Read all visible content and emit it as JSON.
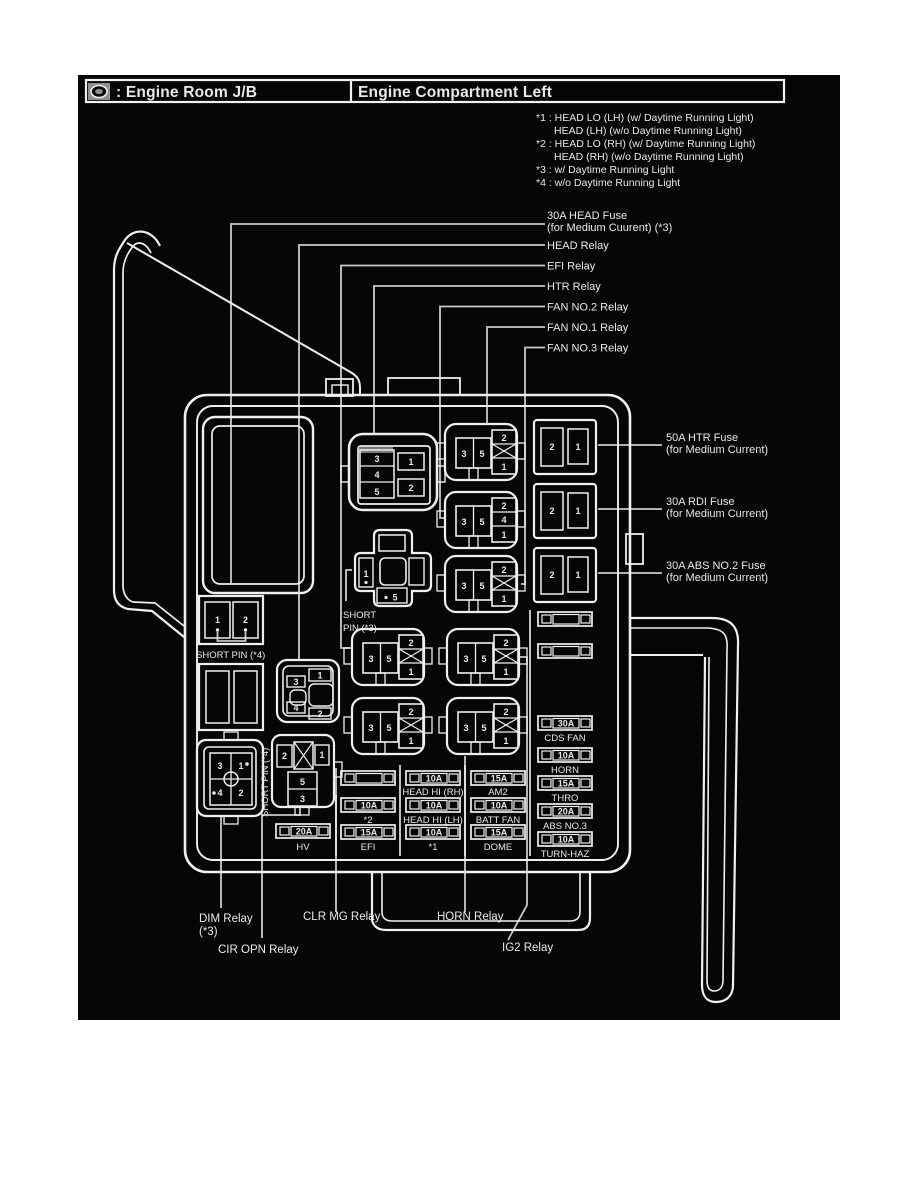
{
  "header": {
    "left_label": ": Engine Room J/B",
    "right_label": "Engine Compartment Left"
  },
  "notes": [
    "*1 : HEAD LO (LH) (w/ Daytime Running Light)",
    "HEAD (LH) (w/o Daytime Running Light)",
    "*2 : HEAD LO (RH) (w/ Daytime Running Light)",
    "HEAD (RH) (w/o Daytime Running Light)",
    "*3 : w/ Daytime Running Light",
    "*4 : w/o Daytime Running Light"
  ],
  "callouts": {
    "head_fuse_1": "30A HEAD Fuse",
    "head_fuse_2": "(for Medium Cuurent) (*3)",
    "head_relay": "HEAD Relay",
    "efi_relay": "EFI Relay",
    "htr_relay": "HTR Relay",
    "fan2_relay": "FAN NO.2 Relay",
    "fan1_relay": "FAN NO.1 Relay",
    "fan3_relay": "FAN NO.3 Relay",
    "htr_fuse_1": "50A HTR Fuse",
    "htr_fuse_2": "(for Medium Current)",
    "rdi_fuse_1": "30A RDI Fuse",
    "rdi_fuse_2": "(for Medium Current)",
    "abs_fuse_1": "30A ABS NO.2 Fuse",
    "abs_fuse_2": "(for Medium Current)",
    "dim_relay_1": "DIM Relay",
    "dim_relay_2": "(*3)",
    "cir_opn_relay": "CIR OPN Relay",
    "clr_mg_relay": "CLR MG Relay",
    "horn_relay": "HORN Relay",
    "ig2_relay": "IG2 Relay",
    "short_pin3_1": "SHORT",
    "short_pin3_2": "PIN (*3)",
    "short_pin4_h": "SHORT PIN (*4)",
    "short_pin4_v": "SHORT PIN (*4)"
  },
  "fuse_grid": {
    "hv": {
      "amp": "20A",
      "name": "HV"
    },
    "star2": {
      "amp": "10A",
      "name": "*2"
    },
    "efi": {
      "amp": "15A",
      "name": "EFI"
    },
    "head_hi_rh": {
      "amp": "10A",
      "name": "HEAD HI (RH)"
    },
    "head_hi_lh": {
      "amp": "10A",
      "name": "HEAD HI (LH)"
    },
    "star1": {
      "amp": "10A",
      "name": "*1"
    },
    "am2": {
      "amp": "15A",
      "name": "AM2"
    },
    "batt_fan": {
      "amp": "10A",
      "name": "BATT FAN"
    },
    "dome": {
      "amp": "15A",
      "name": "DOME"
    },
    "cds_fan": {
      "amp": "30A",
      "name": "CDS FAN"
    },
    "horn": {
      "amp": "10A",
      "name": "HORN"
    },
    "thro": {
      "amp": "15A",
      "name": "THRO"
    },
    "abs_no3": {
      "amp": "20A",
      "name": "ABS NO.3"
    },
    "turn_haz": {
      "amp": "10A",
      "name": "TURN-HAZ"
    }
  },
  "pins": {
    "htr_relay": {
      "r1": "3",
      "r2": "4",
      "r3": "5",
      "c1": "1",
      "c2": "2"
    },
    "fan_no1": {
      "l1": "3",
      "l2": "5",
      "t": "2",
      "b": "1"
    },
    "fan_no2": {
      "l1": "3",
      "l2": "5",
      "t": "2",
      "m": "4",
      "b": "1"
    },
    "fan_no3": {
      "l1": "3",
      "l2": "5",
      "t": "2",
      "b": "1"
    },
    "efi": {
      "l1": "3",
      "l2": "5",
      "t": "2",
      "b": "1"
    },
    "ig2": {
      "l1": "3",
      "l2": "5",
      "t": "2",
      "b": "1"
    },
    "clr_mg": {
      "l1": "3",
      "l2": "5",
      "t": "2",
      "b": "1"
    },
    "horn": {
      "l1": "3",
      "l2": "5",
      "t": "2",
      "b": "1"
    },
    "head_relay": {
      "p3": "3",
      "p1": "1",
      "p4": "4",
      "p2": "2"
    },
    "dim_relay": {
      "p3": "3",
      "p1": "1",
      "p4": "4",
      "p2": "2"
    },
    "cir_opn": {
      "p2": "2",
      "p1": "1",
      "p5": "5",
      "p3": "3"
    },
    "short_pin3": {
      "p1": "1",
      "p5": "5"
    },
    "short_pin4": {
      "p1": "1",
      "p2": "2"
    },
    "cartridge": {
      "left": "2",
      "right": "1"
    }
  },
  "colors": {
    "panel_bg": "#060606",
    "line": "#efefef",
    "leader": "#c9c9c9"
  }
}
